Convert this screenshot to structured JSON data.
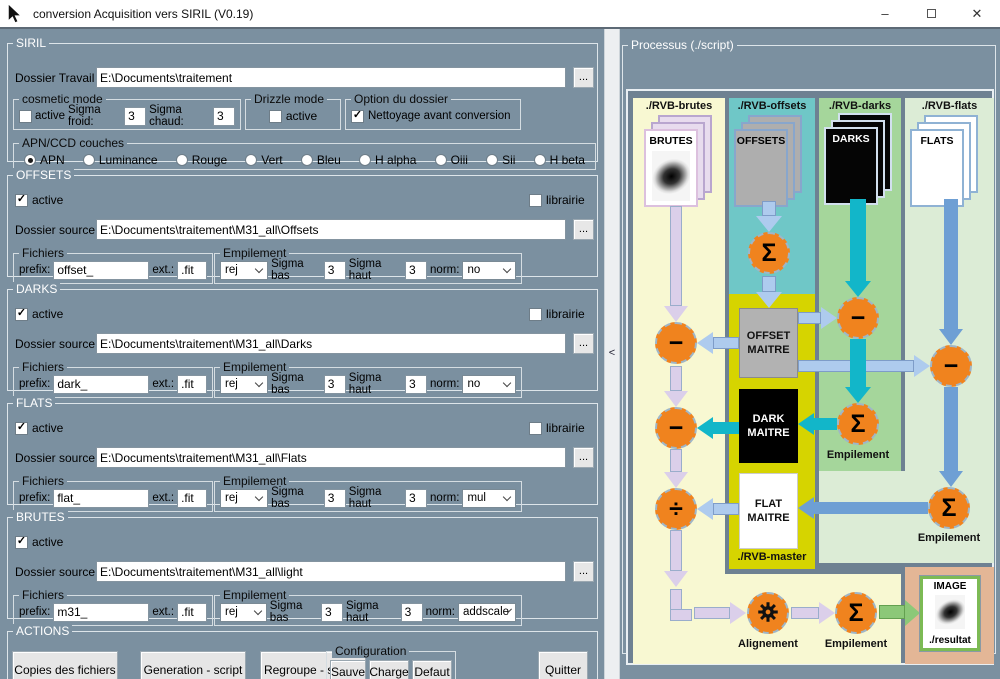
{
  "window": {
    "title": "conversion Acquisition vers SIRIL (V0.19)",
    "minimize_glyph": "–",
    "close_glyph": "✕"
  },
  "siril": {
    "title": "SIRIL",
    "work_dir_label": "Dossier Travail :",
    "work_dir_value": "E:\\Documents\\traitement",
    "browse_label": "...",
    "cosmetic": {
      "title": "cosmetic mode",
      "active_label": "active",
      "active_checked": false,
      "sigma_froid_label": "Sigma froid:",
      "sigma_froid_value": "3",
      "sigma_chaud_label": "Sigma chaud:",
      "sigma_chaud_value": "3"
    },
    "drizzle": {
      "title": "Drizzle mode",
      "active_label": "active",
      "active_checked": false
    },
    "option": {
      "title": "Option du dossier",
      "cleanup_label": "Nettoyage avant conversion",
      "cleanup_checked": true
    },
    "couches": {
      "title": "APN/CCD couches",
      "options": [
        "APN",
        "Luminance",
        "Rouge",
        "Vert",
        "Bleu",
        "H alpha",
        "Oiii",
        "Sii",
        "H beta"
      ],
      "selected": "APN"
    }
  },
  "sections": [
    {
      "title": "OFFSETS",
      "active_label": "active",
      "active_checked": true,
      "librairie_label": "librairie",
      "librairie_checked": false,
      "has_librairie": true,
      "source_label": "Dossier source :",
      "source_value": "E:\\Documents\\traitement\\M31_all\\Offsets",
      "browse_label": "...",
      "fichiers": {
        "title": "Fichiers",
        "prefix_label": "prefix:",
        "prefix_value": "offset_",
        "ext_label": "ext.:",
        "ext_value": ".fit"
      },
      "empilement": {
        "title": "Empilement",
        "method_value": "rej",
        "sigma_bas_label": "Sigma bas",
        "sigma_bas_value": "3",
        "sigma_haut_label": "Sigma haut",
        "sigma_haut_value": "3",
        "norm_label": "norm:",
        "norm_value": "no"
      }
    },
    {
      "title": "DARKS",
      "active_label": "active",
      "active_checked": true,
      "librairie_label": "librairie",
      "librairie_checked": false,
      "has_librairie": true,
      "source_label": "Dossier source :",
      "source_value": "E:\\Documents\\traitement\\M31_all\\Darks",
      "browse_label": "...",
      "fichiers": {
        "title": "Fichiers",
        "prefix_label": "prefix:",
        "prefix_value": "dark_",
        "ext_label": "ext.:",
        "ext_value": ".fit"
      },
      "empilement": {
        "title": "Empilement",
        "method_value": "rej",
        "sigma_bas_label": "Sigma bas",
        "sigma_bas_value": "3",
        "sigma_haut_label": "Sigma haut",
        "sigma_haut_value": "3",
        "norm_label": "norm:",
        "norm_value": "no"
      }
    },
    {
      "title": "FLATS",
      "active_label": "active",
      "active_checked": true,
      "librairie_label": "librairie",
      "librairie_checked": false,
      "has_librairie": true,
      "source_label": "Dossier source :",
      "source_value": "E:\\Documents\\traitement\\M31_all\\Flats",
      "browse_label": "...",
      "fichiers": {
        "title": "Fichiers",
        "prefix_label": "prefix:",
        "prefix_value": "flat_",
        "ext_label": "ext.:",
        "ext_value": ".fit"
      },
      "empilement": {
        "title": "Empilement",
        "method_value": "rej",
        "sigma_bas_label": "Sigma bas",
        "sigma_bas_value": "3",
        "sigma_haut_label": "Sigma haut",
        "sigma_haut_value": "3",
        "norm_label": "norm:",
        "norm_value": "mul"
      }
    },
    {
      "title": "BRUTES",
      "active_label": "active",
      "active_checked": true,
      "librairie_label": "librairie",
      "librairie_checked": false,
      "has_librairie": false,
      "source_label": "Dossier source :",
      "source_value": "E:\\Documents\\traitement\\M31_all\\light",
      "browse_label": "...",
      "fichiers": {
        "title": "Fichiers",
        "prefix_label": "prefix:",
        "prefix_value": "m31_",
        "ext_label": "ext.:",
        "ext_value": ".fit"
      },
      "empilement": {
        "title": "Empilement",
        "method_value": "rej",
        "sigma_bas_label": "Sigma bas",
        "sigma_bas_value": "3",
        "sigma_haut_label": "Sigma haut",
        "sigma_haut_value": "3",
        "norm_label": "norm:",
        "norm_value": "addscale"
      }
    }
  ],
  "actions": {
    "title": "ACTIONS",
    "copy_label": "Copies des fichiers",
    "generate_label": "Generation - script",
    "regroup_label": "Regroupe - scripts",
    "configuration": {
      "title": "Configuration",
      "save_label": "Sauve",
      "load_label": "Charge",
      "default_label": "Defaut"
    },
    "quit_label": "Quitter"
  },
  "splitter": {
    "collapse_glyph": "<"
  },
  "processus": {
    "title": "Processus (./script)",
    "headers": [
      "./RVB-brutes",
      "./RVB-offsets",
      "./RVB-darks",
      "./RVB-flats"
    ],
    "stacks": {
      "brutes": "BRUTES",
      "offsets": "OFFSETS",
      "darks": "DARKS",
      "flats": "FLATS"
    },
    "masters": {
      "offset": "OFFSET MAITRE",
      "dark": "DARK MAITRE",
      "flat": "FLAT MAITRE",
      "folder_label": "./RVB-master"
    },
    "node_labels": {
      "empilement_darks": "Empilement",
      "empilement_flats": "Empilement",
      "alignement": "Alignement",
      "empilement_final": "Empilement"
    },
    "result": {
      "title": "IMAGE",
      "folder_label": "./resultat"
    },
    "symbols": {
      "sum": "Σ",
      "subtract": "−",
      "divide": "÷"
    },
    "colors": {
      "brutes_bg": "#f8f8d2",
      "offsets_bg": "#6fc7c7",
      "darks_bg": "#a5d69b",
      "flats_bg": "#dcecd6",
      "master_bg": "#d6d400",
      "result_bg": "#e3b696",
      "node_orange": "#f0831e",
      "arrow_lavender": "#dbcfea",
      "arrow_blue": "#aecbee",
      "arrow_teal": "#12b6c9",
      "arrow_steel": "#6e9fd4",
      "arrow_green": "#8cc878"
    }
  }
}
